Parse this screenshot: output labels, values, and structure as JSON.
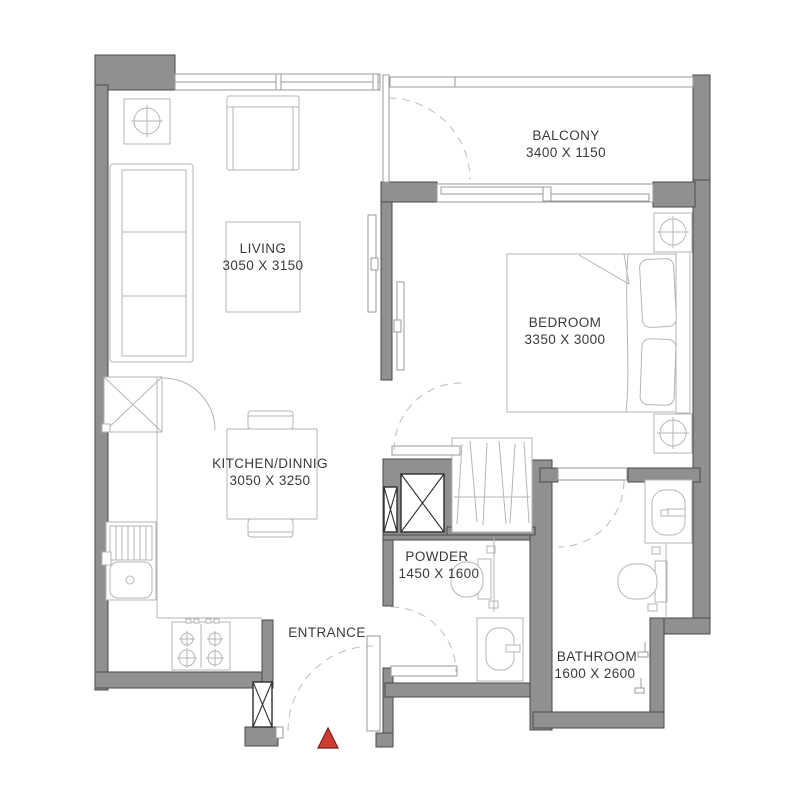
{
  "plan": {
    "title": "apartment-floor-plan",
    "rooms": {
      "living": {
        "name": "LIVING",
        "dims": "3050 X 3150"
      },
      "kitchen": {
        "name": "KITCHEN/DINNIG",
        "dims": "3050 X 3250"
      },
      "bedroom": {
        "name": "BEDROOM",
        "dims": "3350 X 3000"
      },
      "balcony": {
        "name": "BALCONY",
        "dims": "3400 X 1150"
      },
      "powder": {
        "name": "POWDER",
        "dims": "1450 X 1600"
      },
      "bathroom": {
        "name": "BATHROOM",
        "dims": "1600 X 2600"
      },
      "entrance": {
        "name": "ENTRANCE"
      }
    },
    "colors": {
      "wall": "#909090",
      "furniture_line": "#b5b5b5",
      "text": "#3a3a3a",
      "entrance_marker": "#cf3a32"
    }
  }
}
